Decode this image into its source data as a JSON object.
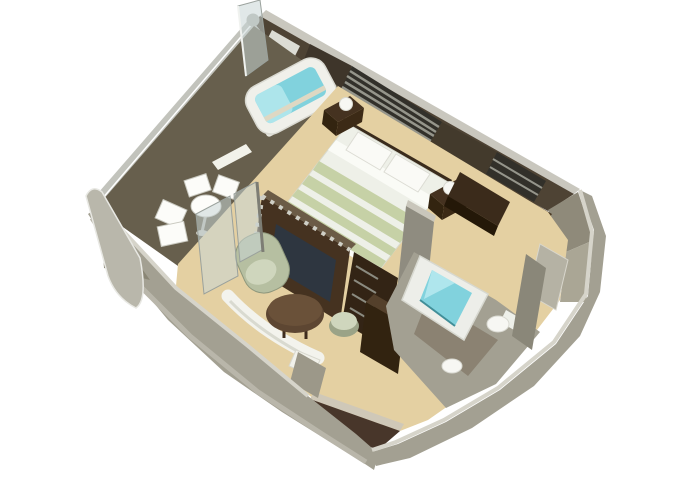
{
  "meta": {
    "title": "Isometric 3D cutaway floor plan of a cruise-ship suite with veranda"
  },
  "palette": {
    "white_bg": "#ffffff",
    "carpet": "#e5d0a1",
    "deck": "#675f4c",
    "wall_grey": "#a3a092",
    "wall_grey2": "#8b8776",
    "wall_top": "#d6d4ca",
    "railing": "#c2c3bc",
    "ne_wall": "#4e4334",
    "slat_dark": "#32302a",
    "slat_light": "#95958b",
    "dark_wood": "#45321f",
    "darker_wood": "#2c1e0f",
    "linen_white": "#eef0e8",
    "linen_sage": "#c6d1a5",
    "tub_water": "#7fd3de",
    "tub_water_light": "#b4e8ef",
    "fixture_white": "#f7f7f3",
    "chair_sage": "#b6bfa0",
    "chair_sage_light": "#cfd6bc",
    "table_brown": "#5e4631",
    "glass_tint": "rgba(200,213,214,0.55)",
    "bath_floor": "#8b8271"
  },
  "scene": {
    "rooms": [
      {
        "name": "veranda",
        "furniture": [
          {
            "name": "whirlpool-tub",
            "count": 1
          },
          {
            "name": "deck-chair",
            "count": 4
          },
          {
            "name": "round-table",
            "count": 1
          },
          {
            "name": "railing",
            "count": 1
          }
        ]
      },
      {
        "name": "bedroom",
        "furniture": [
          {
            "name": "double-bed",
            "count": 1
          },
          {
            "name": "pillow",
            "count": 2
          },
          {
            "name": "nightstand",
            "count": 2
          },
          {
            "name": "table-lamp",
            "count": 2
          },
          {
            "name": "slatted-window",
            "count": 2
          }
        ]
      },
      {
        "name": "living-room",
        "furniture": [
          {
            "name": "sofa",
            "count": 1
          },
          {
            "name": "armchair",
            "count": 1
          },
          {
            "name": "coffee-table",
            "count": 1
          },
          {
            "name": "ottoman",
            "count": 1
          },
          {
            "name": "tv-console",
            "count": 1
          },
          {
            "name": "side-table",
            "count": 1
          }
        ]
      },
      {
        "name": "bathroom",
        "furniture": [
          {
            "name": "bathtub",
            "count": 1
          },
          {
            "name": "toilet",
            "count": 1
          },
          {
            "name": "sink",
            "count": 1
          }
        ]
      },
      {
        "name": "walk-in-closet",
        "furniture": [
          {
            "name": "wardrobe",
            "count": 2
          },
          {
            "name": "mirror-panel",
            "count": 1
          }
        ]
      },
      {
        "name": "entry-hall",
        "furniture": []
      }
    ]
  }
}
